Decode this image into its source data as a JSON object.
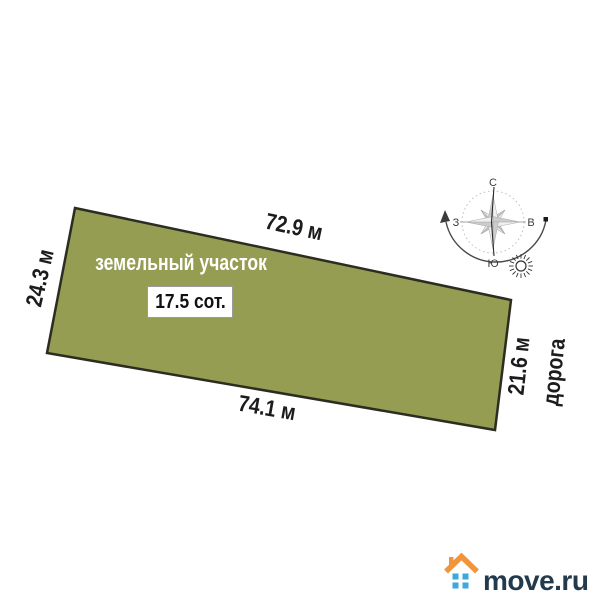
{
  "diagram": {
    "plot_label": "земельный участок",
    "area_label": "17.5 сот.",
    "dimensions": {
      "top": "72.9 м",
      "left": "24.3 м",
      "bottom": "74.1 м",
      "right": "21.6 м"
    },
    "road_label": "дорога",
    "plot_fill": "#949d52",
    "plot_border": "#2c2c20"
  },
  "compass": {
    "north": "С",
    "south": "Ю",
    "west": "З",
    "east": "В"
  },
  "icons": {
    "compass": "compass-rose",
    "sun": "sun-icon",
    "sun_path": "sun-path-arc",
    "house": "house-logo-icon"
  },
  "logo": {
    "text": "move.ru",
    "roof_color": "#f0953c",
    "window_color": "#3ea7dc",
    "text_color": "#233a4c"
  }
}
